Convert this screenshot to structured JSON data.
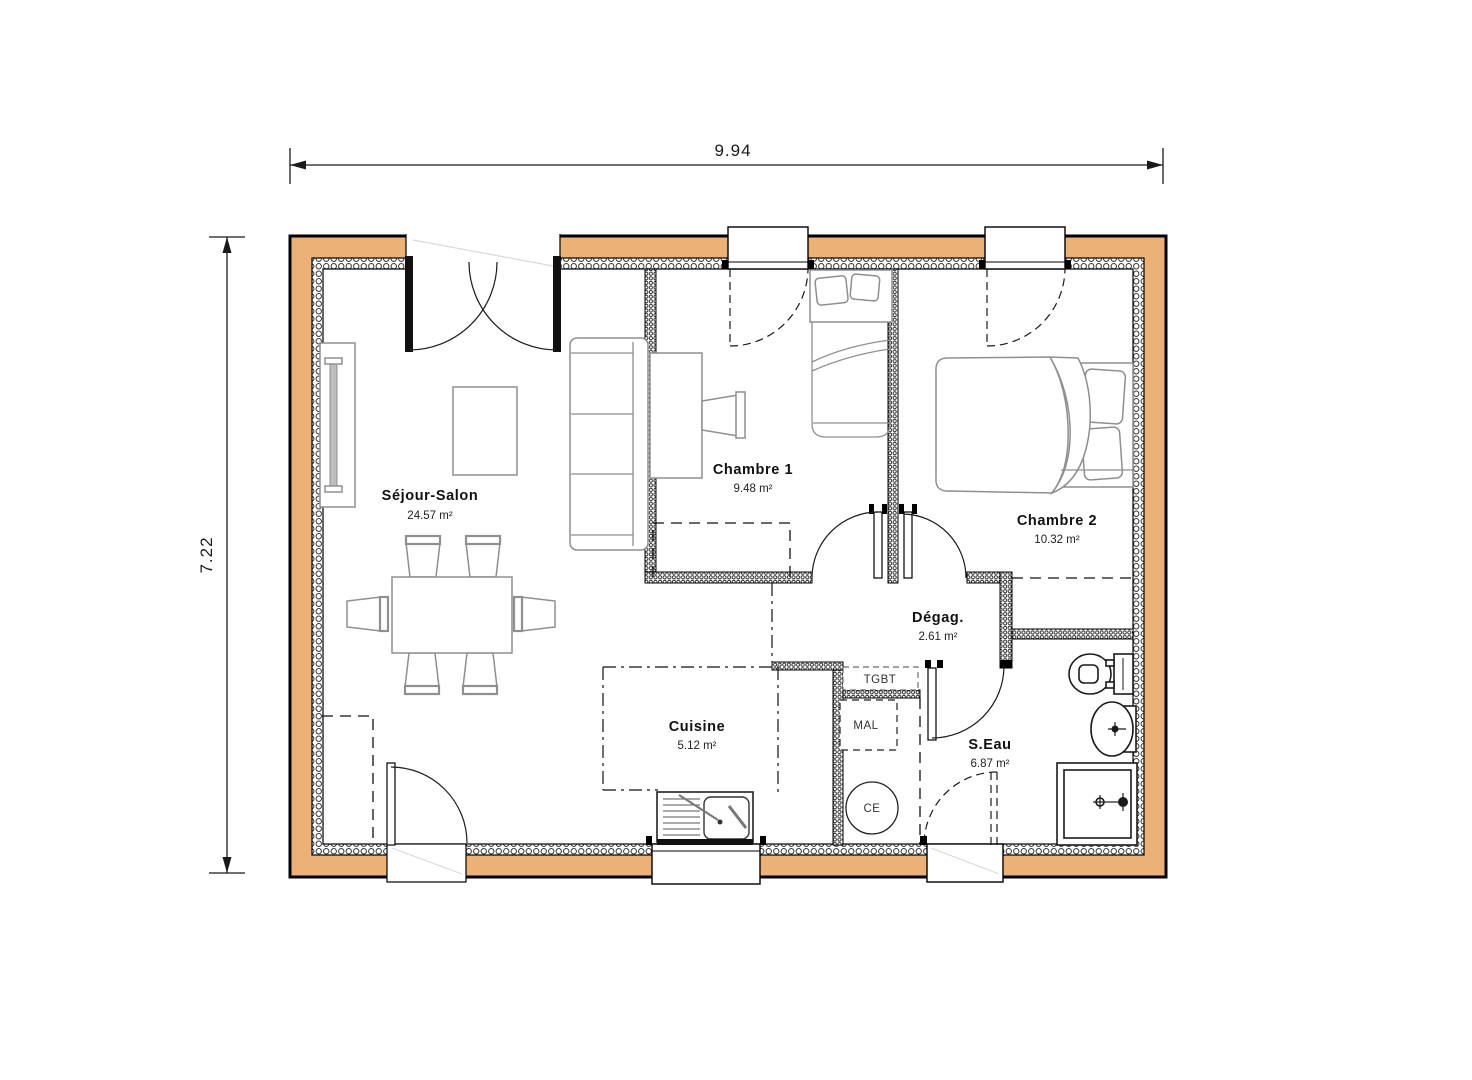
{
  "plan": {
    "dimensions": {
      "width": "9.94",
      "height": "7.22"
    },
    "rooms": [
      {
        "id": "sejour-salon",
        "name": "Séjour-Salon",
        "area": "24.57 m²"
      },
      {
        "id": "chambre-1",
        "name": "Chambre 1",
        "area": "9.48 m²"
      },
      {
        "id": "chambre-2",
        "name": "Chambre 2",
        "area": "10.32 m²"
      },
      {
        "id": "degagement",
        "name": "Dégag.",
        "area": "2.61 m²"
      },
      {
        "id": "cuisine",
        "name": "Cuisine",
        "area": "5.12 m²"
      },
      {
        "id": "salle-eau",
        "name": "S.Eau",
        "area": "6.87 m²"
      }
    ],
    "equipment": {
      "tgbt": "TGBT",
      "mal": "MAL",
      "ce": "CE"
    },
    "colors": {
      "wall_fill": "#ECB177",
      "line": "#000000",
      "furniture_line": "#8F8F8F"
    }
  }
}
